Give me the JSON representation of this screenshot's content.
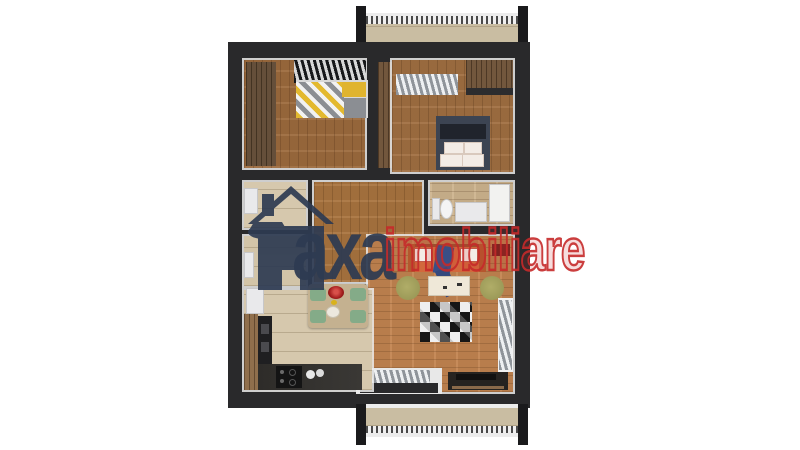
{
  "watermark": {
    "logo_icon": "house-logo-icon",
    "brand_primary": "axa",
    "brand_secondary": "imobiliare"
  },
  "palette": {
    "background": "#ffffff",
    "wall": "#29292b",
    "wall_dark": "#1a1a1c",
    "brand_navy": "#2e3b52",
    "brand_red": "#c62a2a",
    "bedroom_floor": "#9c6a3d",
    "bedroom2_floor": "#a06f41",
    "hallway_floor": "#a9743f",
    "living_floor": "#c28450",
    "kitchen_floor": "#d6c8ad",
    "utility_floor": "#d2c4a8",
    "bathroom_floor": "#cdb48e",
    "balcony_floor": "#c9bda2",
    "wardrobe_wood": "#5d462f",
    "door_wood": "#6b4e33",
    "sofa": "#d2693c",
    "sofa_arm": "#b5572e",
    "pouf": "#9c9a58",
    "chair": "#84ab88",
    "table": "#c4b190",
    "coffee_table": "#efe8d8",
    "bowl": "#a21d1d",
    "bed2": "#3c4452",
    "rug_dark": "#161616",
    "rug_light": "#efefef",
    "counter": "#3a3835"
  },
  "scene": {
    "type": "3d-apartment-floor-plan-render",
    "furniture_counts": {
      "dining_chairs": 4,
      "poufs": 2,
      "beds": 2,
      "balconies": 2
    }
  }
}
